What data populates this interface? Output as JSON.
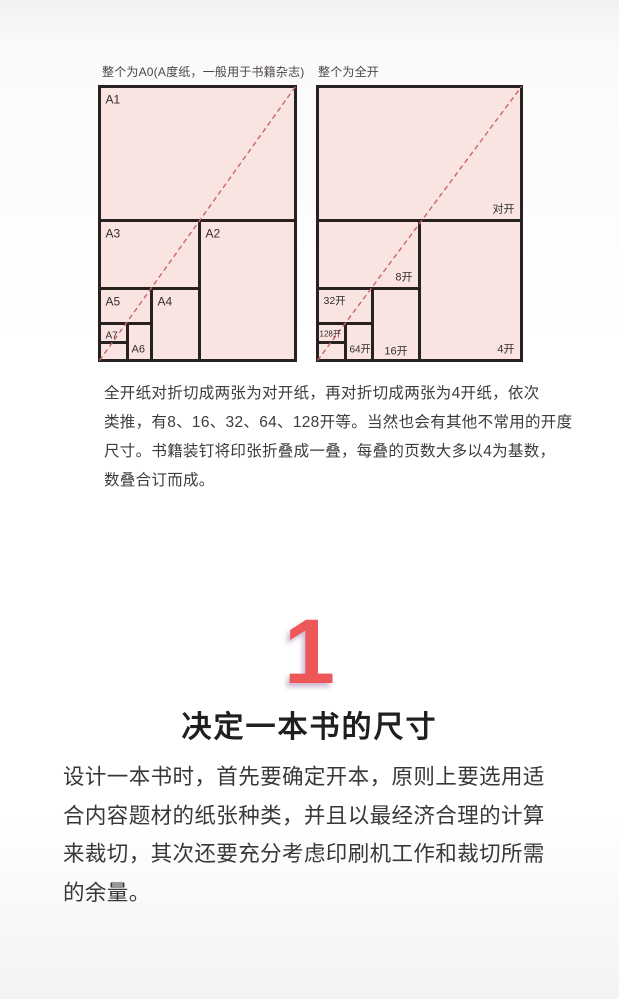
{
  "colors": {
    "cell_fill": "#f9e4e2",
    "cell_border": "#272220",
    "diagonal_dash": "#c96765",
    "accent_number": "#ee5757"
  },
  "diagrams": [
    {
      "id": "a-series",
      "caption": "整个为A0(A度纸，一般用于书籍杂志)",
      "width": 196,
      "height": 274,
      "cells": [
        {
          "label": "A1",
          "x": 0,
          "y": 0,
          "w": 196,
          "h": 134,
          "pos": "tl",
          "fs": 12
        },
        {
          "label": "A2",
          "x": 100,
          "y": 134,
          "w": 96,
          "h": 140,
          "pos": "tl",
          "fs": 12
        },
        {
          "label": "A3",
          "x": 0,
          "y": 134,
          "w": 100,
          "h": 68,
          "pos": "tl",
          "fs": 12
        },
        {
          "label": "A4",
          "x": 52,
          "y": 202,
          "w": 48,
          "h": 72,
          "pos": "tl",
          "fs": 12
        },
        {
          "label": "A5",
          "x": 0,
          "y": 202,
          "w": 52,
          "h": 35,
          "pos": "tl",
          "fs": 12
        },
        {
          "label": "A6",
          "x": 28,
          "y": 237,
          "w": 24,
          "h": 37,
          "pos": "bl",
          "fs": 11
        },
        {
          "label": "A7",
          "x": 0,
          "y": 237,
          "w": 28,
          "h": 19,
          "pos": "tl",
          "fs": 10
        },
        {
          "label": "",
          "x": 0,
          "y": 256,
          "w": 28,
          "h": 18,
          "pos": "none",
          "fs": 0
        }
      ]
    },
    {
      "id": "kai-series",
      "caption": "整个为全开",
      "width": 204,
      "height": 274,
      "cells": [
        {
          "label": "对开",
          "x": 0,
          "y": 0,
          "w": 204,
          "h": 134,
          "pos": "br",
          "fs": 11
        },
        {
          "label": "4开",
          "x": 102,
          "y": 134,
          "w": 102,
          "h": 140,
          "pos": "br",
          "fs": 11
        },
        {
          "label": "8开",
          "x": 0,
          "y": 134,
          "w": 102,
          "h": 68,
          "pos": "br",
          "fs": 11
        },
        {
          "label": "16开",
          "x": 55,
          "y": 202,
          "w": 47,
          "h": 72,
          "pos": "bc",
          "fs": 11
        },
        {
          "label": "32开",
          "x": 0,
          "y": 202,
          "w": 55,
          "h": 35,
          "pos": "tl",
          "fs": 10.5
        },
        {
          "label": "64开",
          "x": 28,
          "y": 237,
          "w": 27,
          "h": 37,
          "pos": "bl",
          "fs": 10
        },
        {
          "label": "128开",
          "x": 0,
          "y": 237,
          "w": 28,
          "h": 19,
          "pos": "tl",
          "fs": 8
        },
        {
          "label": "",
          "x": 0,
          "y": 256,
          "w": 28,
          "h": 18,
          "pos": "none",
          "fs": 0
        }
      ]
    }
  ],
  "figure_note": "全开纸对折切成两张为对开纸，再对折切成两张为4开纸，依次\n类推，有8、16、32、64、128开等。当然也会有其他不常用的开度\n尺寸。书籍装钉将印张折叠成一叠，每叠的页数大多以4为基数，\n数叠合订而成。",
  "section": {
    "number": "1",
    "title": "决定一本书的尺寸",
    "body": "设计一本书时，首先要确定开本，原则上要选用适\n合内容题材的纸张种类，并且以最经济合理的计算\n来裁切，其次还要充分考虑印刷机工作和裁切所需\n的余量。"
  }
}
